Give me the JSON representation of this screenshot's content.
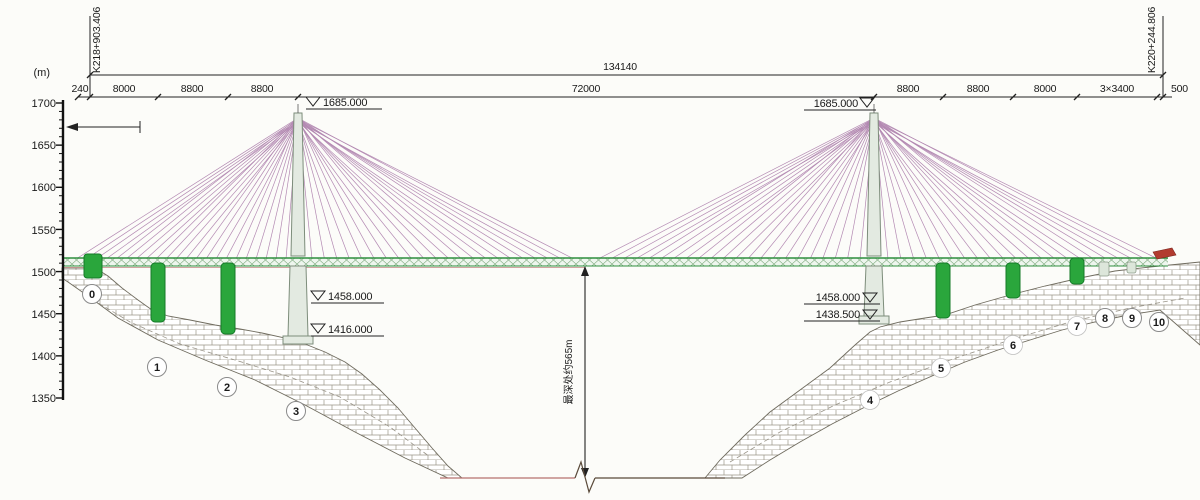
{
  "drawing": {
    "title": "cable-stayed bridge elevation",
    "stations": {
      "left": "K218+903.406",
      "right": "K220+244.806"
    },
    "axis": {
      "unit": "(m)",
      "ticks": [
        "1700",
        "1650",
        "1600",
        "1550",
        "1500",
        "1450",
        "1400",
        "1350"
      ]
    },
    "dimensions": {
      "total": "134140",
      "segments": [
        "240",
        "8000",
        "8800",
        "8800",
        "72000",
        "8800",
        "8800",
        "8000",
        "3×3400",
        "500"
      ]
    },
    "elevations": {
      "left_tower_top": "1685.000",
      "right_tower_top": "1685.000",
      "left_cap": "1458.000",
      "left_foundation": "1416.000",
      "right_cap": "1458.000",
      "right_foundation": "1438.500"
    },
    "piers": [
      "0",
      "1",
      "2",
      "3",
      "4",
      "5",
      "6",
      "7",
      "8",
      "9",
      "10"
    ],
    "depth_note": "最深处约565m",
    "colors": {
      "cable": "#b389b2",
      "deck_green": "#2f8f3f",
      "deck_fill": "#eef6ee",
      "pier_green": "#2aa63c",
      "pier_green_dark": "#157a28",
      "tower_fill": "#e3eae1",
      "tower_stroke": "#7d8d7b",
      "ground_stroke": "#8a8578",
      "red_marker": "#b23b30",
      "ink": "#1a1a1a"
    }
  }
}
